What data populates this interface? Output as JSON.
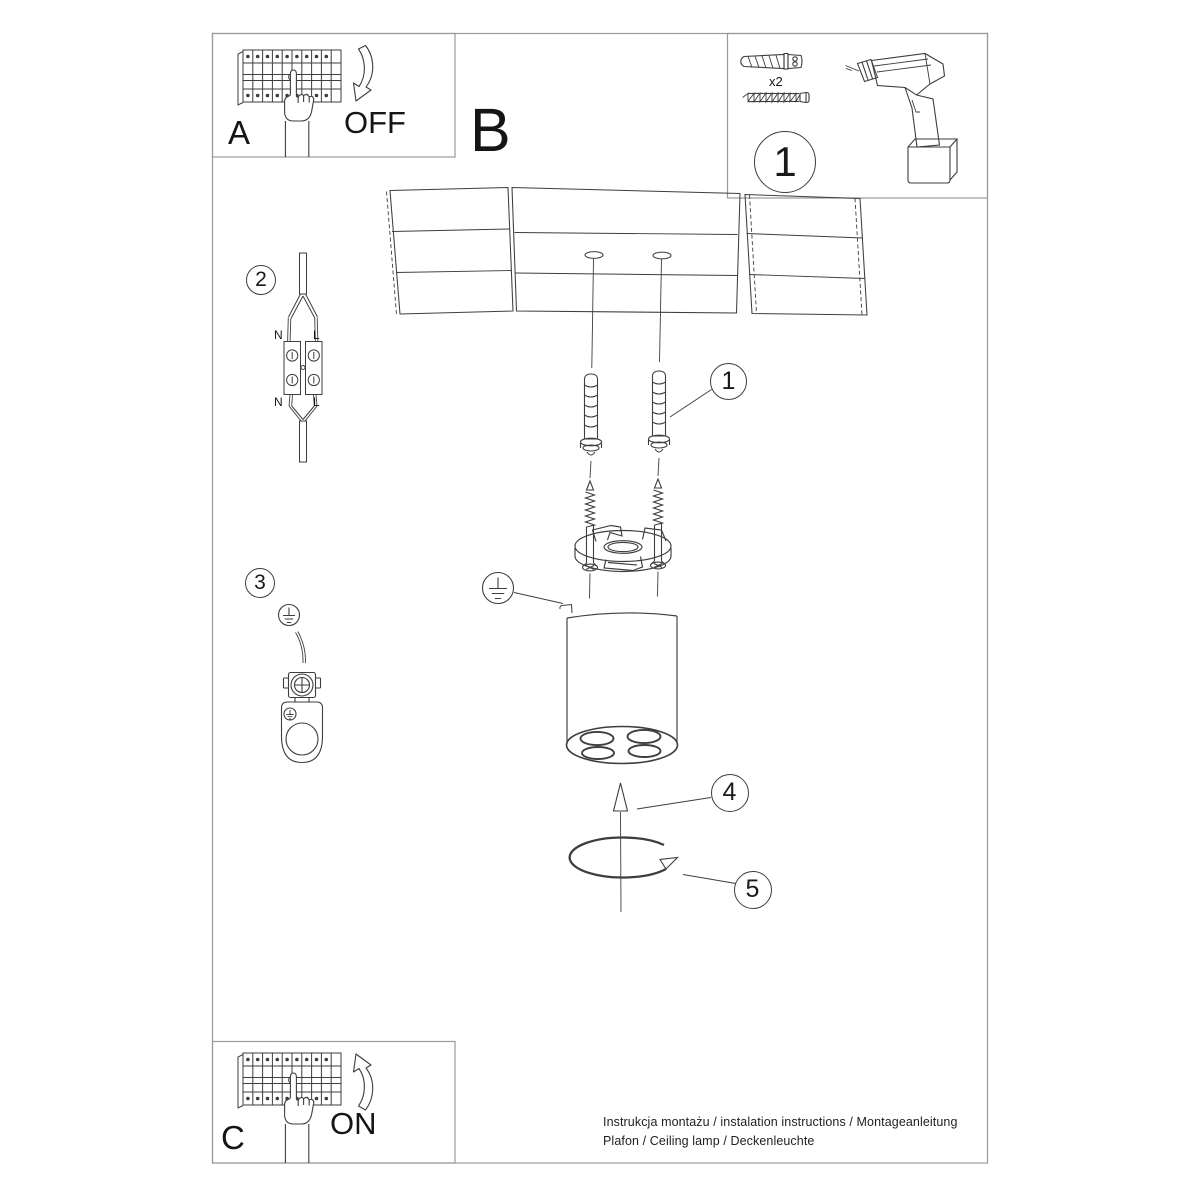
{
  "document": {
    "footer": {
      "line1": "Instrukcja montażu / instalation instructions / Montageanleitung",
      "line2": "Plafon / Ceiling lamp / Deckenleuchte"
    },
    "sections": {
      "breaker_off": {
        "label": "A",
        "state": "OFF"
      },
      "main_view": {
        "label": "B"
      },
      "tools": {
        "step": "1",
        "quantity": "x2"
      },
      "wiring": {
        "step": "2",
        "neutral": "N",
        "live": "L"
      },
      "ground": {
        "step": "3"
      },
      "anchor_callout": {
        "step": "1"
      },
      "push_callout": {
        "step": "4"
      },
      "twist_callout": {
        "step": "5"
      },
      "breaker_on": {
        "label": "C",
        "state": "ON"
      }
    }
  },
  "colors": {
    "line": "#3e3e3e",
    "border": "#9a9a9a",
    "text": "#151515",
    "background": "#ffffff"
  }
}
